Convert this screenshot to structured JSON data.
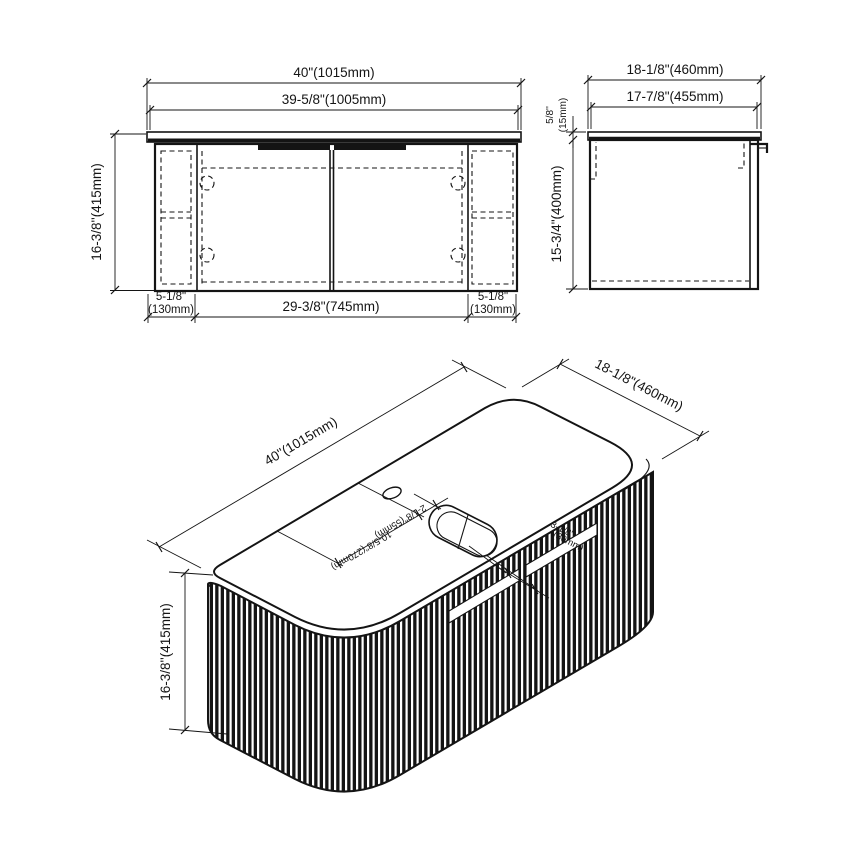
{
  "front": {
    "width_outer": "40\"(1015mm)",
    "width_inner": "39-5/8\"(1005mm)",
    "height": "16-3/8''(415mm)",
    "left_in": "5-1/8\"",
    "left_mm": "(130mm)",
    "center_width": "29-3/8\"(745mm)",
    "right_in": "5-1/8\"",
    "right_mm": "(130mm)"
  },
  "side": {
    "depth_outer": "18-1/8\"(460mm)",
    "depth_inner": "17-7/8\"(455mm)",
    "counter_in": "5/8''",
    "counter_mm": "(15mm)",
    "height": "15-3/4\"(400mm)"
  },
  "iso": {
    "width": "40''(1015mm)",
    "depth": "18-1/8\"(460mm)",
    "height": "16-3/8''(415mm)",
    "faucet": "2-1/8\"(55mm)",
    "sink_center": "10-5/8\"(270mm)",
    "drain_in": "3-1/8\"",
    "drain_mm": "(80mm)"
  },
  "colors": {
    "line": "#141414",
    "background": "#ffffff"
  }
}
